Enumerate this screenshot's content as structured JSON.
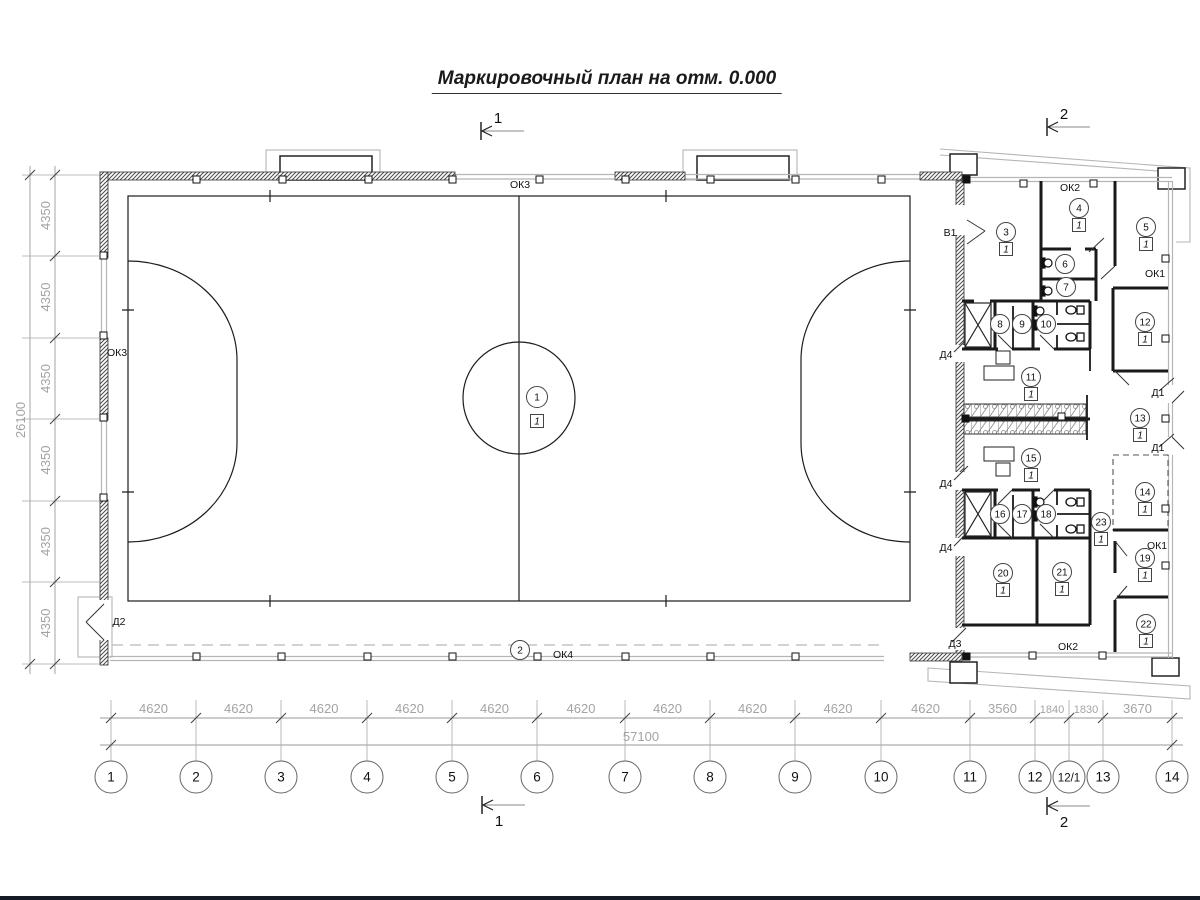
{
  "title": {
    "text": "Маркировочный план на отм. 0.000"
  },
  "section_markers": [
    {
      "label": "1",
      "x": 478,
      "y": 131,
      "label_pos": "above"
    },
    {
      "label": "2",
      "x": 1044,
      "y": 127,
      "label_pos": "above"
    },
    {
      "label": "1",
      "x": 479,
      "y": 805,
      "label_pos": "below"
    },
    {
      "label": "2",
      "x": 1044,
      "y": 806,
      "label_pos": "below"
    }
  ],
  "rooms": [
    {
      "num": "1",
      "floor": "1",
      "x": 537,
      "y": 397
    },
    {
      "num": "2",
      "floor": null,
      "x": 520,
      "y": 650
    },
    {
      "num": "3",
      "floor": "1",
      "x": 1006,
      "y": 232
    },
    {
      "num": "4",
      "floor": "1",
      "x": 1079,
      "y": 208
    },
    {
      "num": "5",
      "floor": "1",
      "x": 1146,
      "y": 227
    },
    {
      "num": "6",
      "floor": null,
      "x": 1065,
      "y": 264
    },
    {
      "num": "7",
      "floor": null,
      "x": 1066,
      "y": 287
    },
    {
      "num": "8",
      "floor": null,
      "x": 1000,
      "y": 324
    },
    {
      "num": "9",
      "floor": null,
      "x": 1022,
      "y": 324
    },
    {
      "num": "10",
      "floor": null,
      "x": 1046,
      "y": 324
    },
    {
      "num": "11",
      "floor": "1",
      "x": 1031,
      "y": 377
    },
    {
      "num": "12",
      "floor": "1",
      "x": 1145,
      "y": 322
    },
    {
      "num": "13",
      "floor": "1",
      "x": 1140,
      "y": 418
    },
    {
      "num": "14",
      "floor": "1",
      "x": 1145,
      "y": 492
    },
    {
      "num": "15",
      "floor": "1",
      "x": 1031,
      "y": 458
    },
    {
      "num": "16",
      "floor": null,
      "x": 1000,
      "y": 514
    },
    {
      "num": "17",
      "floor": null,
      "x": 1022,
      "y": 514
    },
    {
      "num": "18",
      "floor": null,
      "x": 1046,
      "y": 514
    },
    {
      "num": "19",
      "floor": "1",
      "x": 1145,
      "y": 558
    },
    {
      "num": "20",
      "floor": "1",
      "x": 1003,
      "y": 573
    },
    {
      "num": "21",
      "floor": "1",
      "x": 1062,
      "y": 572
    },
    {
      "num": "22",
      "floor": "1",
      "x": 1146,
      "y": 624
    },
    {
      "num": "23",
      "floor": "1",
      "x": 1101,
      "y": 522
    }
  ],
  "labels": [
    {
      "text": "ОК3",
      "x": 520,
      "y": 188
    },
    {
      "text": "ОК3",
      "x": 117,
      "y": 356
    },
    {
      "text": "ОК2",
      "x": 1070,
      "y": 191
    },
    {
      "text": "ОК1",
      "x": 1155,
      "y": 277
    },
    {
      "text": "Д1",
      "x": 1158,
      "y": 396
    },
    {
      "text": "Д1",
      "x": 1158,
      "y": 451
    },
    {
      "text": "ОК1",
      "x": 1157,
      "y": 549
    },
    {
      "text": "ОК2",
      "x": 1068,
      "y": 650
    },
    {
      "text": "ОК4",
      "x": 563,
      "y": 658
    },
    {
      "text": "Д2",
      "x": 119,
      "y": 625
    },
    {
      "text": "Д3",
      "x": 955,
      "y": 647
    },
    {
      "text": "Д4",
      "x": 946,
      "y": 358
    },
    {
      "text": "Д4",
      "x": 946,
      "y": 487
    },
    {
      "text": "Д4",
      "x": 946,
      "y": 551
    },
    {
      "text": "В1",
      "x": 950,
      "y": 236
    }
  ],
  "axes_bottom": {
    "dim_line_y": 718,
    "total_line_y": 745,
    "bubble_y": 777,
    "bubble_r": 16,
    "bubbles": [
      {
        "label": "1",
        "x": 111
      },
      {
        "label": "2",
        "x": 196
      },
      {
        "label": "3",
        "x": 281
      },
      {
        "label": "4",
        "x": 367
      },
      {
        "label": "5",
        "x": 452
      },
      {
        "label": "6",
        "x": 537
      },
      {
        "label": "7",
        "x": 625
      },
      {
        "label": "8",
        "x": 710
      },
      {
        "label": "9",
        "x": 795
      },
      {
        "label": "10",
        "x": 881
      },
      {
        "label": "11",
        "x": 970
      },
      {
        "label": "12",
        "x": 1035
      },
      {
        "label": "12/1",
        "x": 1069
      },
      {
        "label": "13",
        "x": 1103
      },
      {
        "label": "14",
        "x": 1172
      }
    ],
    "segment_values": [
      "4620",
      "4620",
      "4620",
      "4620",
      "4620",
      "4620",
      "4620",
      "4620",
      "4620",
      "4620",
      "3560",
      "1840",
      "1830",
      "3670"
    ],
    "total": {
      "value": "57100",
      "x": 641
    }
  },
  "axes_left": {
    "dim_line_x": 55,
    "total_line_x": 30,
    "ticks": [
      175,
      256,
      338,
      419,
      501,
      582,
      664
    ],
    "segment_value": "4350",
    "total": {
      "value": "26100",
      "y": 420
    }
  }
}
